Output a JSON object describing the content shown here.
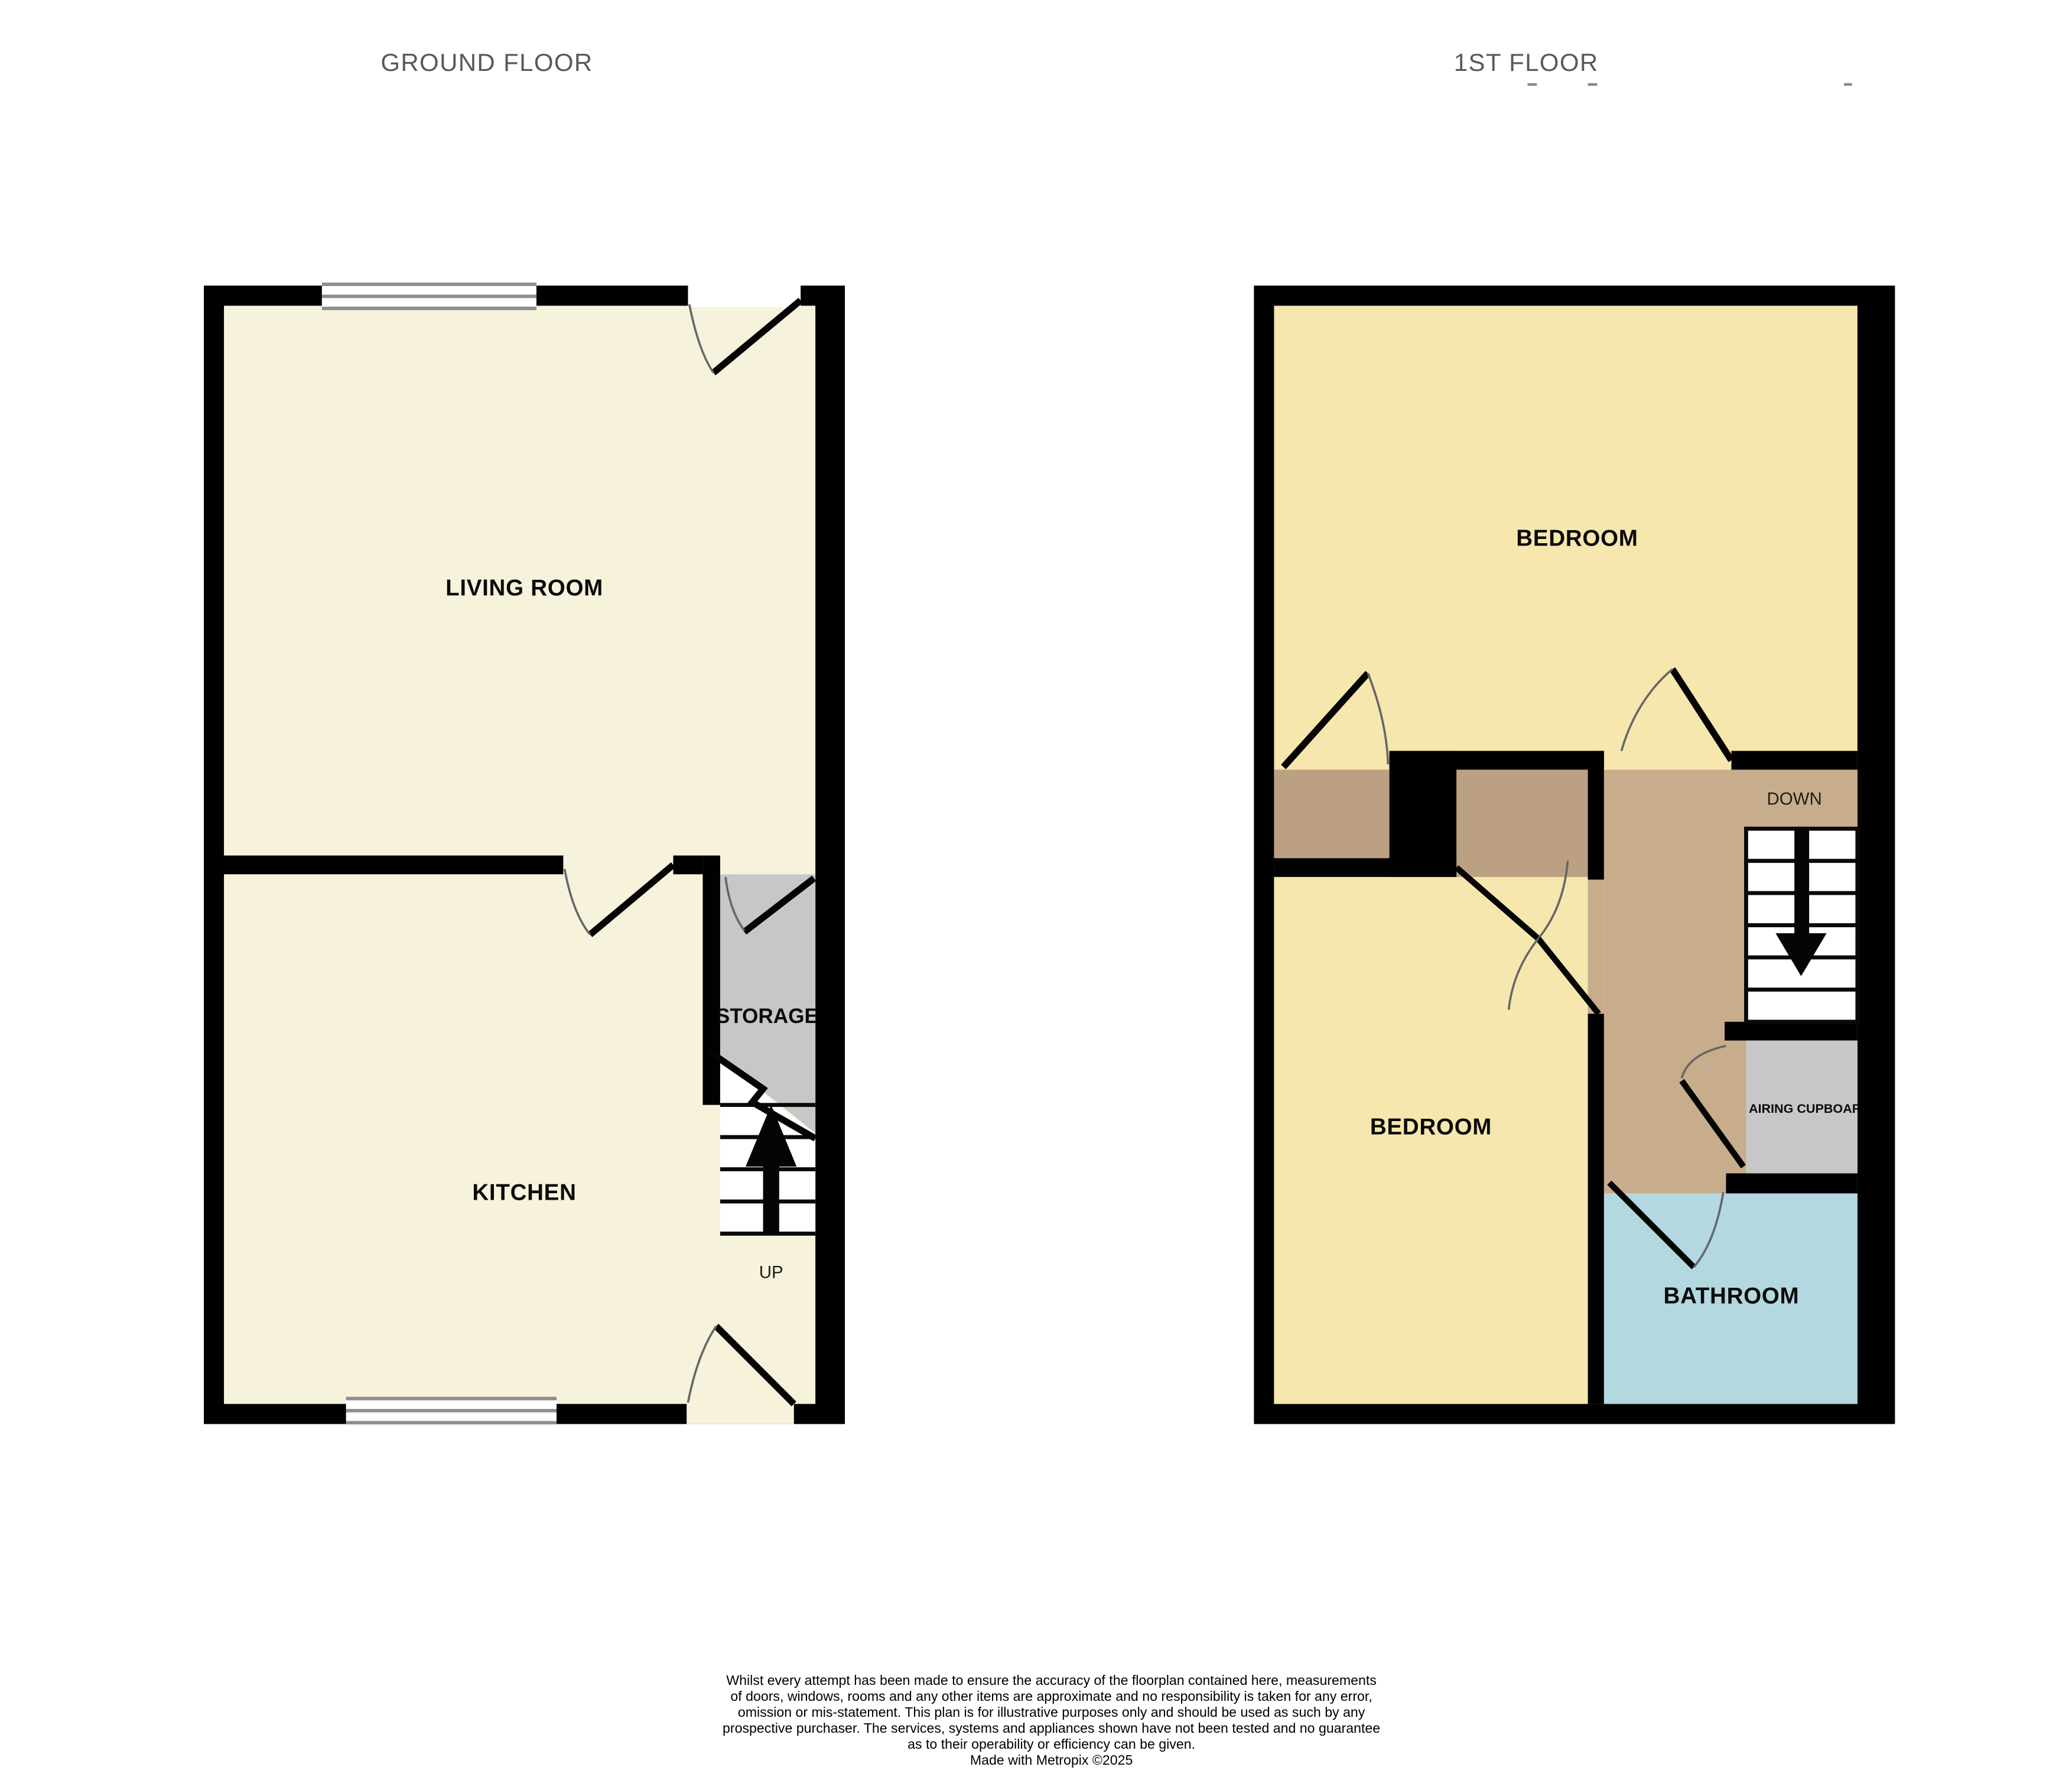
{
  "floors": [
    {
      "title": "GROUND FLOOR",
      "rooms": [
        {
          "label": "LIVING ROOM"
        },
        {
          "label": "KITCHEN"
        },
        {
          "label": "STORAGE"
        }
      ],
      "stairs": {
        "label": "UP",
        "direction": "up"
      }
    },
    {
      "title": "1ST FLOOR",
      "rooms": [
        {
          "label": "BEDROOM"
        },
        {
          "label": "BEDROOM"
        },
        {
          "label": "BATHROOM"
        },
        {
          "label": "AIRING CUPBOARD"
        }
      ],
      "stairs": {
        "label": "DOWN",
        "direction": "down"
      }
    }
  ],
  "disclaimer": {
    "lines": [
      "Whilst every attempt has been made to ensure the accuracy of the floorplan contained here, measurements",
      "of doors, windows, rooms and any other items are approximate and no responsibility is taken for any error,",
      "omission or mis-statement. This plan is for illustrative purposes only and should be used as such by any",
      "prospective purchaser. The services, systems and appliances shown have not been tested and no guarantee",
      "as to their operability or efficiency can be given."
    ],
    "credit": "Made with Metropix ©2025"
  },
  "colors": {
    "wall": "#010101",
    "ground_room_fill": "#F7F2DB",
    "bedroom_fill": "#F6E7AE",
    "hallway_fill": "#C8AD8C",
    "threshold_fill": "#BCA083",
    "storage_fill": "#C7C7C7",
    "bathroom_fill": "#B3D8E0",
    "window_frame": "#8F8F8F",
    "title_text": "#595959"
  }
}
